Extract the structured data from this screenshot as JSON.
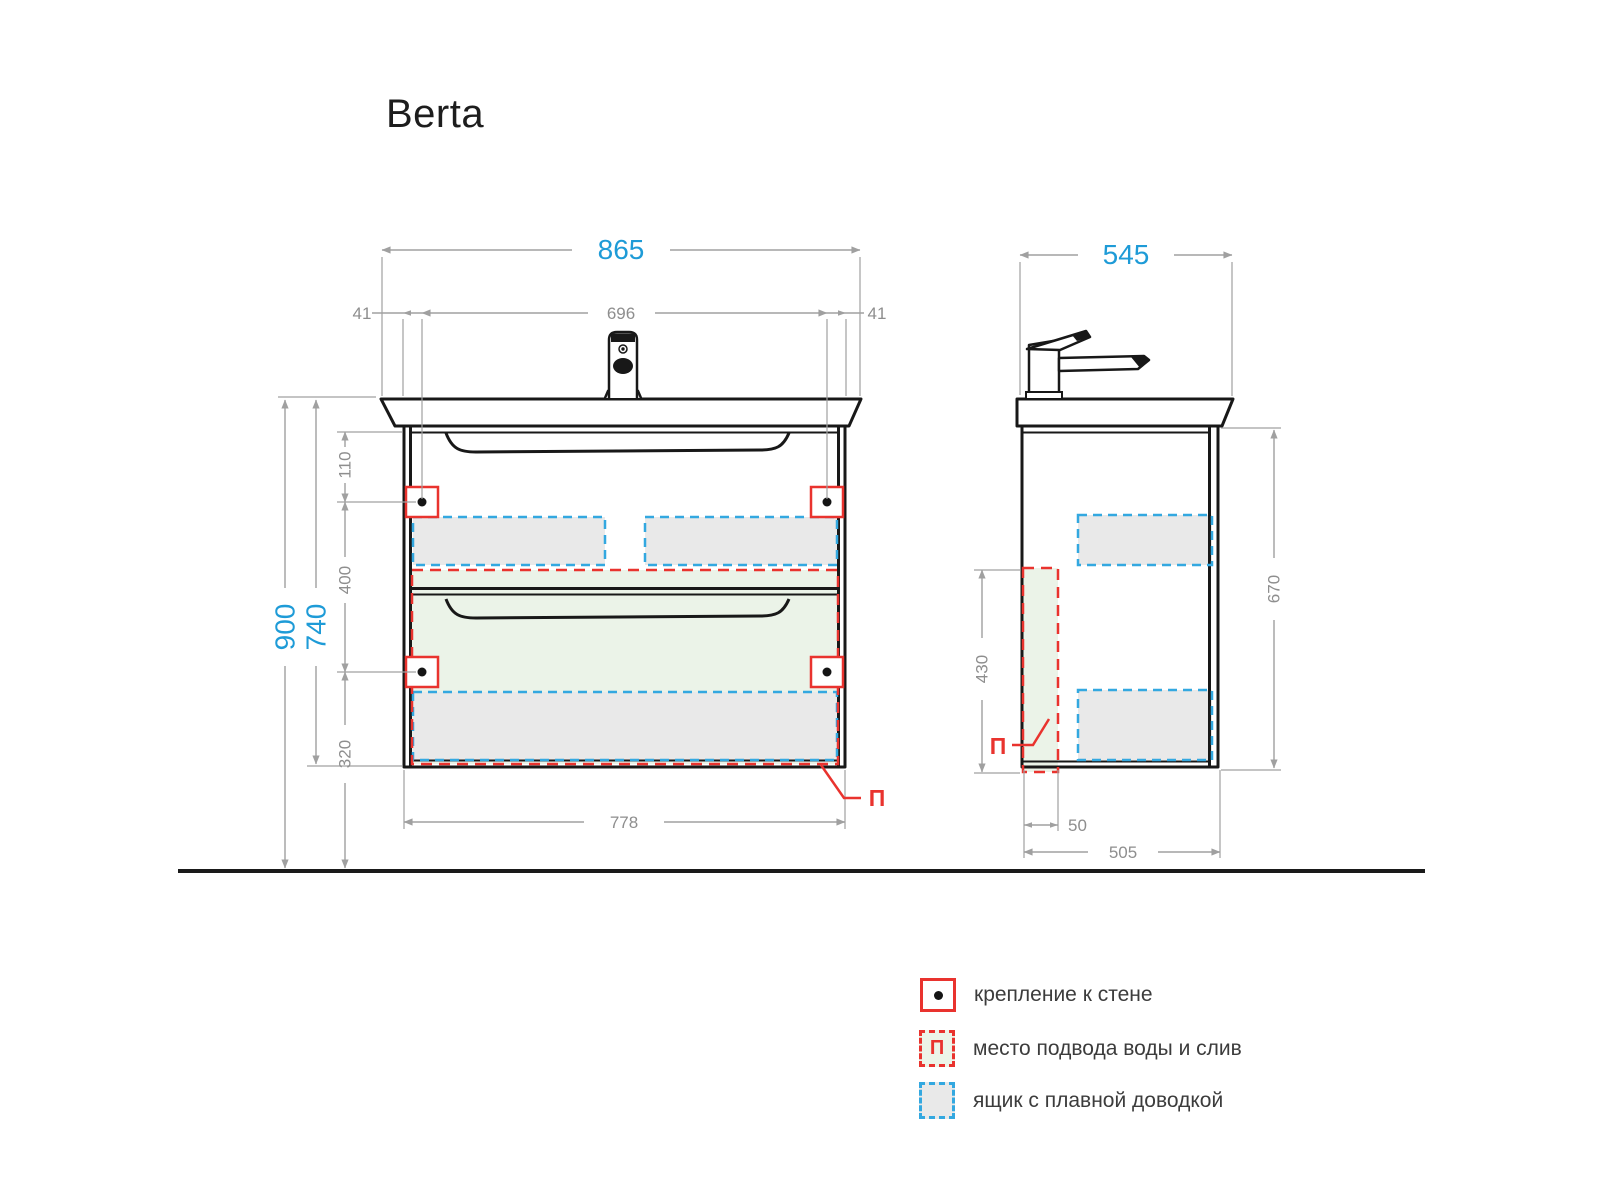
{
  "title": "Berta",
  "front_view": {
    "dims": {
      "overall_width": "865",
      "mount_hole_spacing": "696",
      "mount_offset_left": "41",
      "mount_offset_right": "41",
      "floor_to_sink_top": "900",
      "sink_top_to_cabinet_bottom": "740",
      "cabinet_top_to_hole": "110",
      "hole_to_hole": "400",
      "hole_to_floor": "320",
      "cabinet_width": "778"
    },
    "supply_marker": "П"
  },
  "side_view": {
    "dims": {
      "overall_depth": "545",
      "cabinet_height": "670",
      "supply_zone_height": "430",
      "supply_zone_depth": "50",
      "cabinet_depth": "505"
    },
    "supply_marker": "П"
  },
  "legend": {
    "items": [
      {
        "label": "крепление к стене"
      },
      {
        "label": "место подвода воды и слив",
        "symbol": "П"
      },
      {
        "label": "ящик с плавной доводкой"
      }
    ]
  },
  "colors": {
    "dimension_accent": "#1e9bd7",
    "dimension_gray": "#8e8e8e",
    "mount_red": "#e9332e",
    "drawer_blue": "#33a8e0",
    "drawer_fill": "#e9e9e9",
    "supply_fill": "#ebf3e8",
    "line_black": "#181818"
  }
}
